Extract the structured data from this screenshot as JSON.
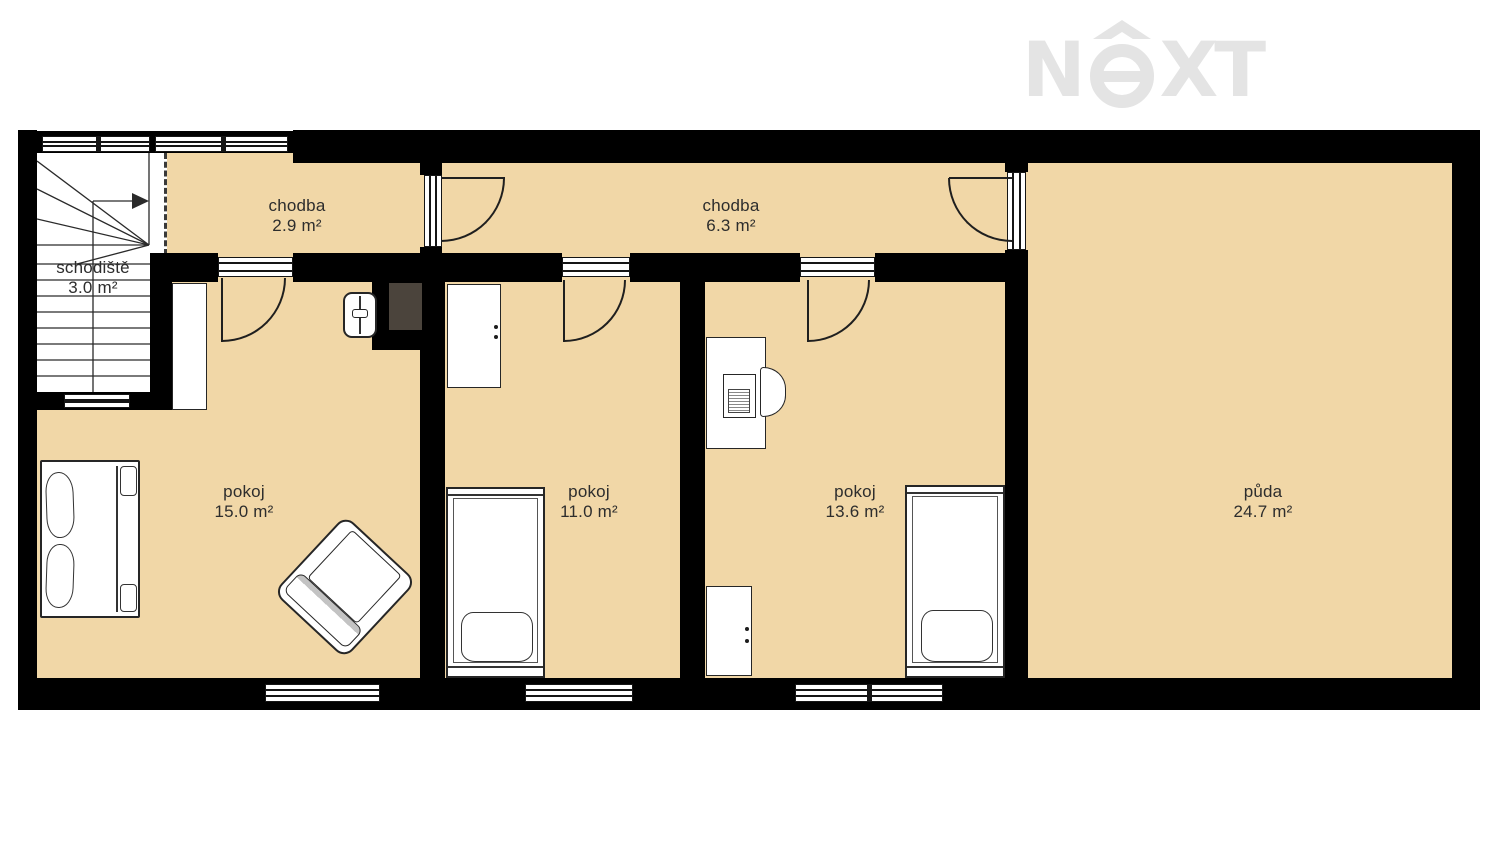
{
  "logo": {
    "letter_n": "N",
    "letter_x": "X",
    "letter_t": "T"
  },
  "rooms": [
    {
      "name": "schodiště",
      "area": "3.0 m²"
    },
    {
      "name": "chodba",
      "area": "2.9 m²"
    },
    {
      "name": "chodba",
      "area": "6.3 m²"
    },
    {
      "name": "pokoj",
      "area": "15.0 m²"
    },
    {
      "name": "pokoj",
      "area": "11.0 m²"
    },
    {
      "name": "pokoj",
      "area": "13.6 m²"
    },
    {
      "name": "půda",
      "area": "24.7 m²"
    }
  ],
  "colors": {
    "floor": "#f1d7a7",
    "wall": "#000000",
    "chimney": "#4b443c",
    "logo": "#e4e4e4",
    "text": "#2d2d2d"
  }
}
